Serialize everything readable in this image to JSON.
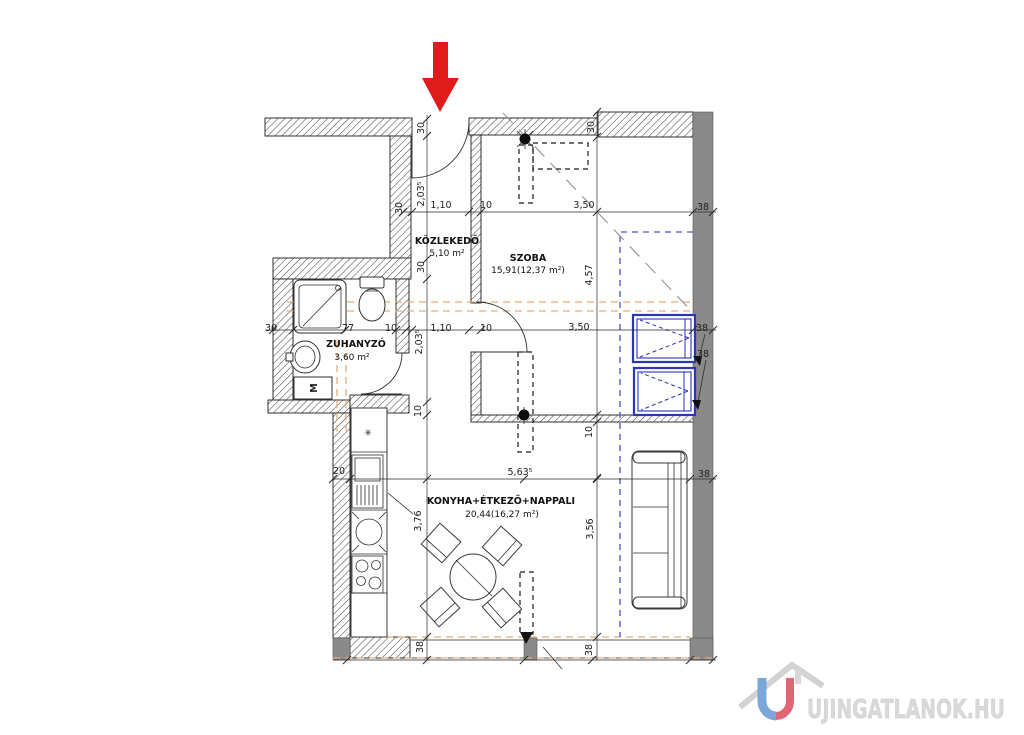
{
  "colors": {
    "wall_solid": "#8a8a8a",
    "window_blue": "#2a35b8",
    "guide_orange": "#e2b07a",
    "guide_blue": "#4b55c0",
    "arrow_red": "#e01b1b",
    "watermark_gray": "#d9d9d9",
    "logo_blue": "#7aa7d6",
    "logo_red": "#e06575"
  },
  "rooms": {
    "kozlekedo": {
      "name": "KÖZLEKEDŐ",
      "area": "5,10 m²"
    },
    "szoba": {
      "name": "SZOBA",
      "area": "15,91(12,37 m²)"
    },
    "zuhanyzo": {
      "name": "ZUHANYZÓ",
      "area": "3,60 m²"
    },
    "nappali": {
      "name": "KONYHA+ÉTKEZŐ+NAPPALI",
      "area": "20,44(16,27 m²)"
    }
  },
  "fixtures": {
    "washer": "M",
    "boiler": "✳"
  },
  "dims": [
    {
      "t": "30"
    },
    {
      "t": "2,03⁵"
    },
    {
      "t": "30"
    },
    {
      "t": "30"
    },
    {
      "t": "2,03⁵"
    },
    {
      "t": "10"
    },
    {
      "t": "3,76"
    },
    {
      "t": "38"
    },
    {
      "t": "30"
    },
    {
      "t": "4,57"
    },
    {
      "t": "10"
    },
    {
      "t": "3,56"
    },
    {
      "t": "38"
    },
    {
      "t": "1,10"
    },
    {
      "t": "10"
    },
    {
      "t": "3,50"
    },
    {
      "t": "38"
    },
    {
      "t": "30"
    },
    {
      "t": "77"
    },
    {
      "t": "10"
    },
    {
      "t": "1,10"
    },
    {
      "t": "10"
    },
    {
      "t": "3,50"
    },
    {
      "t": "38"
    },
    {
      "t": "38"
    },
    {
      "t": "20"
    },
    {
      "t": "5,63⁵"
    },
    {
      "t": "38"
    }
  ],
  "watermark": {
    "text": "UJINGATLANOK.HU"
  }
}
